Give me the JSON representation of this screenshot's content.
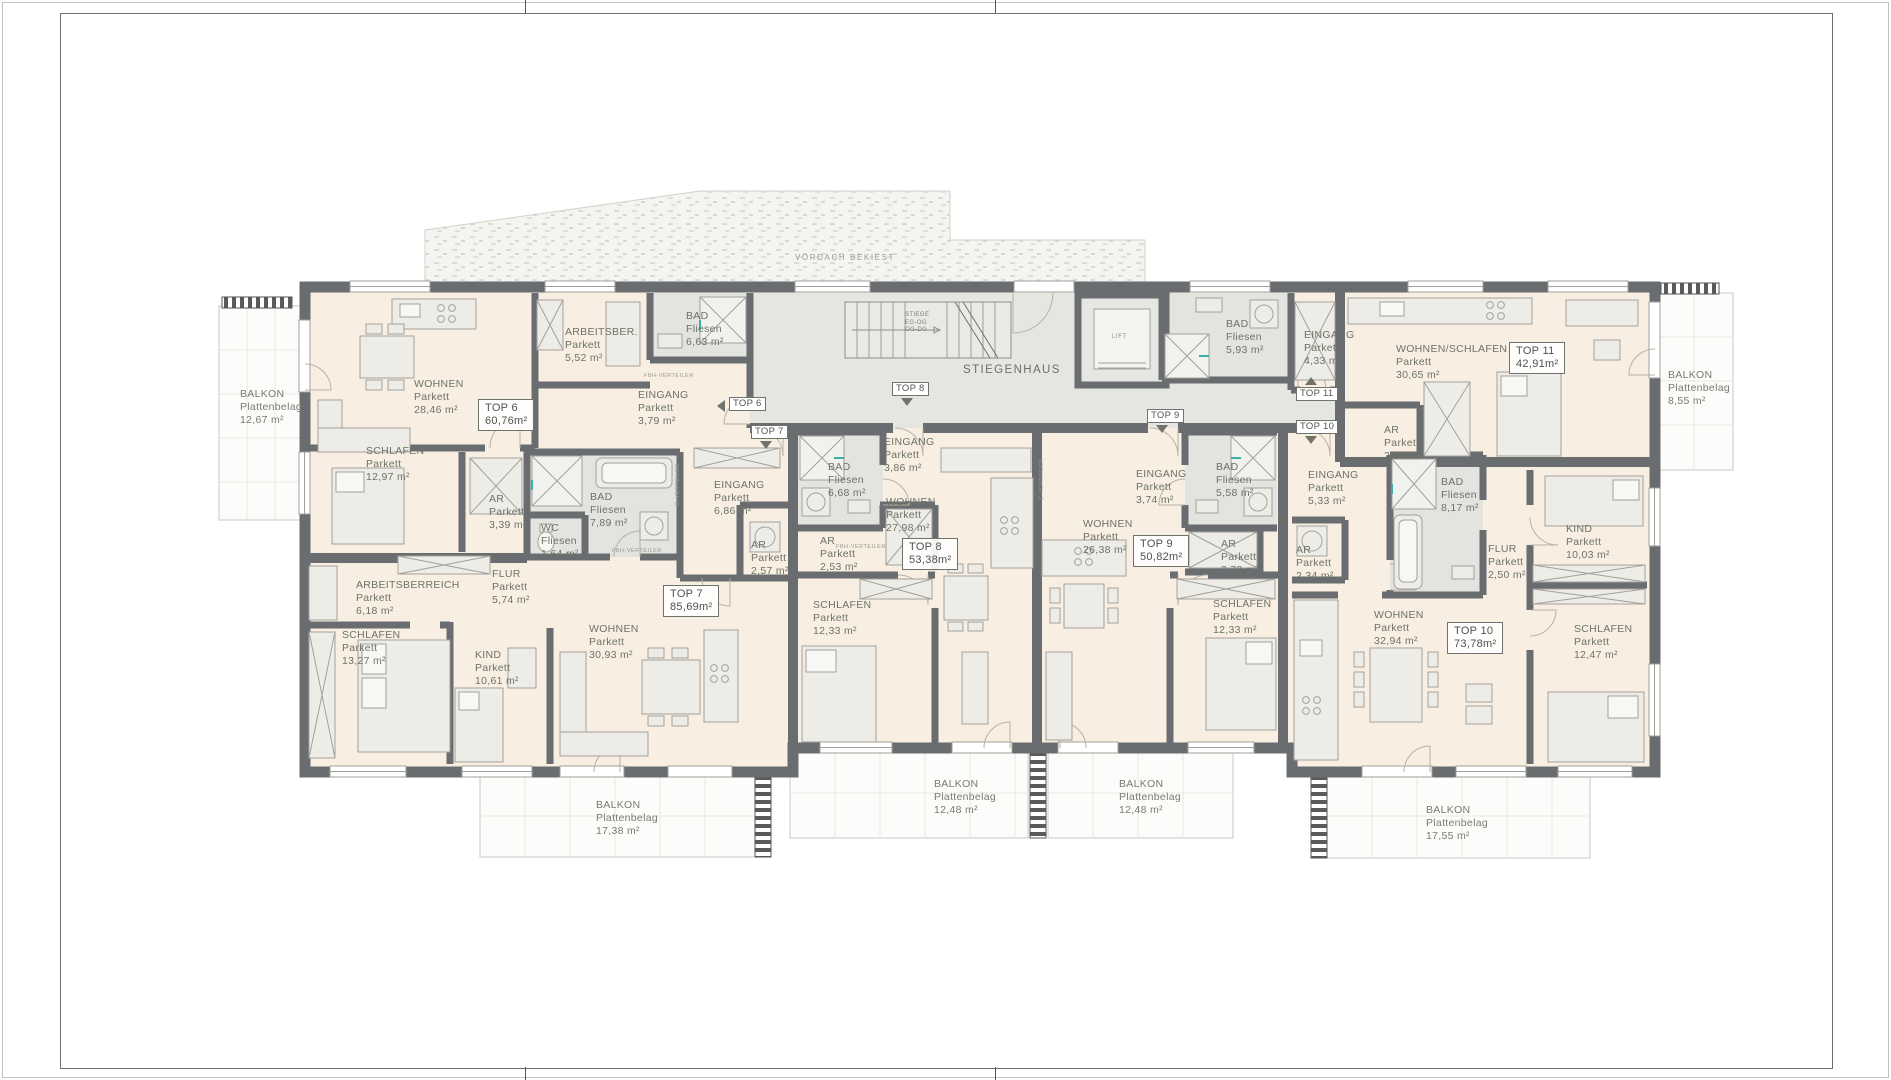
{
  "common": {
    "canopy_label": "VORDACH BEKIEST",
    "stairwell_label": "STIEGENHAUS",
    "stair_lines": {
      "l1": "STIEGE",
      "l2": "EG-OG",
      "l3": "OG-DG"
    },
    "lift_label": "LIFT",
    "tech": {
      "e": "E-VERTEILER",
      "fbh": "FBH-VERTEILER"
    }
  },
  "units": [
    {
      "marker": "TOP 6",
      "size": "60,76m²"
    },
    {
      "marker": "TOP 7",
      "size": "85,69m²"
    },
    {
      "marker": "TOP 8",
      "size": "53,38m²"
    },
    {
      "marker": "TOP 9",
      "size": "50,82m²"
    },
    {
      "marker": "TOP 10",
      "size": "73,78m²"
    },
    {
      "marker": "TOP 11",
      "size": "42,91m²"
    }
  ],
  "rooms": [
    {
      "unit": "TOP 6",
      "name": "WOHNEN",
      "floor": "Parkett",
      "area": "28,46 m²"
    },
    {
      "unit": "TOP 6",
      "name": "ARBEITSBER.",
      "floor": "Parkett",
      "area": "5,52 m²"
    },
    {
      "unit": "TOP 6",
      "name": "BAD",
      "floor": "Fliesen",
      "area": "6,63 m²"
    },
    {
      "unit": "TOP 6",
      "name": "EINGANG",
      "floor": "Parkett",
      "area": "3,79 m²"
    },
    {
      "unit": "TOP 6",
      "name": "SCHLAFEN",
      "floor": "Parkett",
      "area": "12,97 m²"
    },
    {
      "unit": "TOP 6",
      "name": "AR",
      "floor": "Parkett",
      "area": "3,39 m²"
    },
    {
      "unit": "TOP 7",
      "name": "WC",
      "floor": "Fliesen",
      "area": "1,64 m²"
    },
    {
      "unit": "TOP 7",
      "name": "BAD",
      "floor": "Fliesen",
      "area": "7,89 m²"
    },
    {
      "unit": "TOP 7",
      "name": "EINGANG",
      "floor": "Parkett",
      "area": "6,86 m²"
    },
    {
      "unit": "TOP 7",
      "name": "AR",
      "floor": "Parkett",
      "area": "2,57 m²"
    },
    {
      "unit": "TOP 7",
      "name": "FLUR",
      "floor": "Parkett",
      "area": "5,74 m²"
    },
    {
      "unit": "TOP 7",
      "name": "ARBEITSBERREICH",
      "floor": "Parkett",
      "area": "6,18 m²"
    },
    {
      "unit": "TOP 7",
      "name": "SCHLAFEN",
      "floor": "Parkett",
      "area": "13,27 m²"
    },
    {
      "unit": "TOP 7",
      "name": "KIND",
      "floor": "Parkett",
      "area": "10,61 m²"
    },
    {
      "unit": "TOP 7",
      "name": "WOHNEN",
      "floor": "Parkett",
      "area": "30,93 m²"
    },
    {
      "unit": "TOP 8",
      "name": "EINGANG",
      "floor": "Parkett",
      "area": "3,86 m²"
    },
    {
      "unit": "TOP 8",
      "name": "BAD",
      "floor": "Fliesen",
      "area": "6,68 m²"
    },
    {
      "unit": "TOP 8",
      "name": "AR",
      "floor": "Parkett",
      "area": "2,53 m²"
    },
    {
      "unit": "TOP 8",
      "name": "WOHNEN",
      "floor": "Parkett",
      "area": "27,98 m²"
    },
    {
      "unit": "TOP 8",
      "name": "SCHLAFEN",
      "floor": "Parkett",
      "area": "12,33 m²"
    },
    {
      "unit": "TOP 9",
      "name": "EINGANG",
      "floor": "Parkett",
      "area": "3,74 m²"
    },
    {
      "unit": "TOP 9",
      "name": "BAD",
      "floor": "Fliesen",
      "area": "5,58 m²"
    },
    {
      "unit": "TOP 9",
      "name": "AR",
      "floor": "Parkett",
      "area": "2,79 m²"
    },
    {
      "unit": "TOP 9",
      "name": "WOHNEN",
      "floor": "Parkett",
      "area": "26,38 m²"
    },
    {
      "unit": "TOP 9",
      "name": "SCHLAFEN",
      "floor": "Parkett",
      "area": "12,33 m²"
    },
    {
      "unit": "TOP 10",
      "name": "EINGANG",
      "floor": "Parkett",
      "area": "5,33 m²"
    },
    {
      "unit": "TOP 10",
      "name": "AR",
      "floor": "Parkett",
      "area": "2,34 m²"
    },
    {
      "unit": "TOP 10",
      "name": "BAD",
      "floor": "Fliesen",
      "area": "8,17 m²"
    },
    {
      "unit": "TOP 10",
      "name": "FLUR",
      "floor": "Parkett",
      "area": "2,50 m²"
    },
    {
      "unit": "TOP 10",
      "name": "KIND",
      "floor": "Parkett",
      "area": "10,03 m²"
    },
    {
      "unit": "TOP 10",
      "name": "SCHLAFEN",
      "floor": "Parkett",
      "area": "12,47 m²"
    },
    {
      "unit": "TOP 10",
      "name": "WOHNEN",
      "floor": "Parkett",
      "area": "32,94 m²"
    },
    {
      "unit": "TOP 11",
      "name": "BAD",
      "floor": "Fliesen",
      "area": "5,93 m²"
    },
    {
      "unit": "TOP 11",
      "name": "EINGANG",
      "floor": "Parkett",
      "area": "4,33 m²"
    },
    {
      "unit": "TOP 11",
      "name": "WOHNEN/SCHLAFEN",
      "floor": "Parkett",
      "area": "30,65 m²"
    },
    {
      "unit": "TOP 11",
      "name": "AR",
      "floor": "Parkett",
      "area": "2,00 m²"
    }
  ],
  "balconies": [
    {
      "name": "BALKON",
      "floor": "Plattenbelag",
      "area": "12,67 m²"
    },
    {
      "name": "BALKON",
      "floor": "Plattenbelag",
      "area": "17,38 m²"
    },
    {
      "name": "BALKON",
      "floor": "Plattenbelag",
      "area": "12,48 m²"
    },
    {
      "name": "BALKON",
      "floor": "Plattenbelag",
      "area": "12,48 m²"
    },
    {
      "name": "BALKON",
      "floor": "Plattenbelag",
      "area": "17,55 m²"
    },
    {
      "name": "BALKON",
      "floor": "Plattenbelag",
      "area": "8,55 m²"
    }
  ]
}
